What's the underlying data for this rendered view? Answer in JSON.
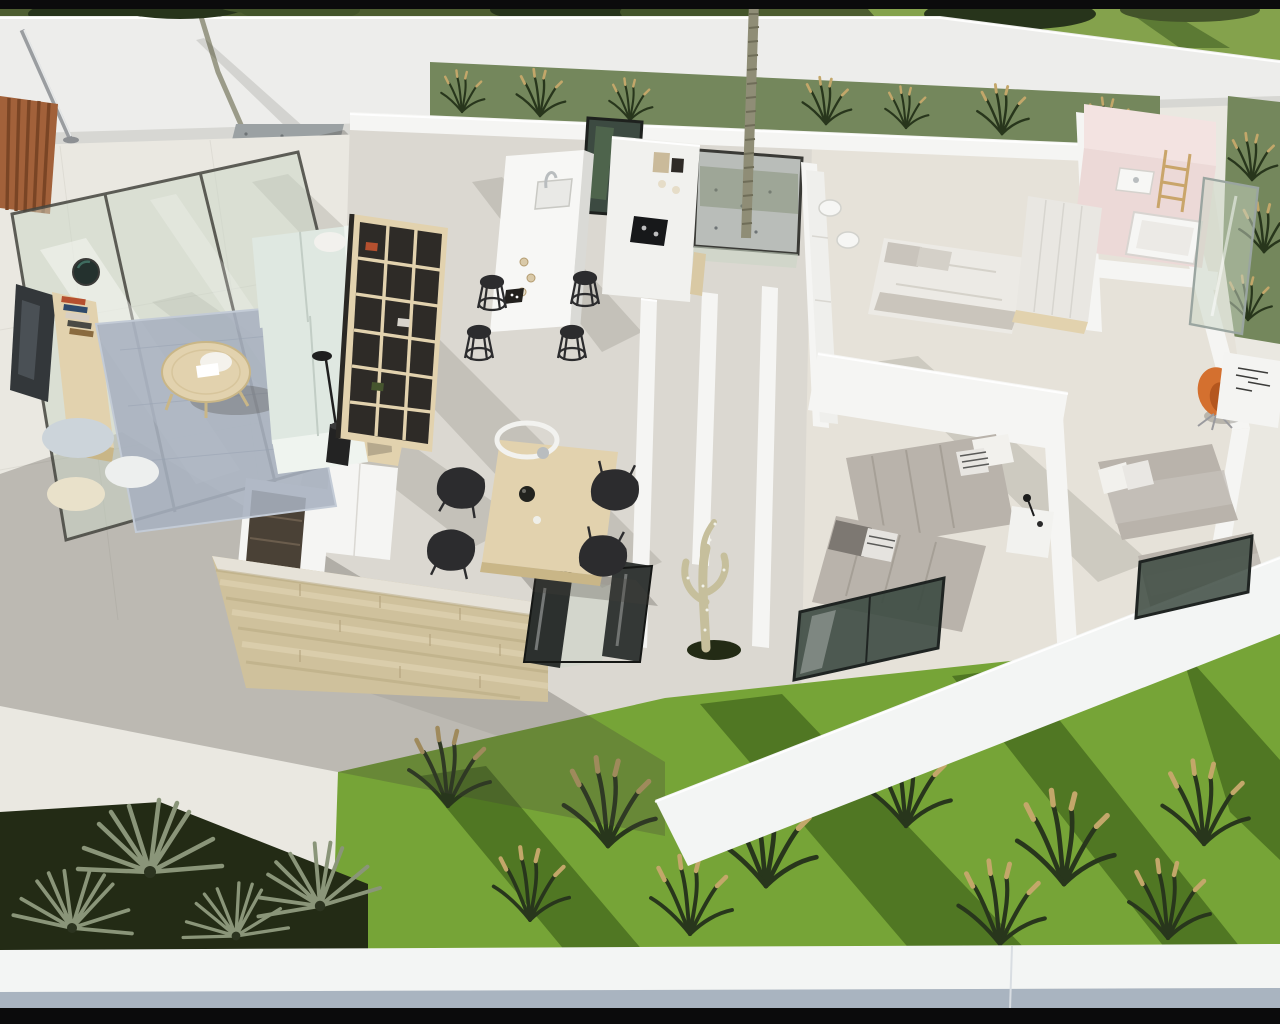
{
  "meta": {
    "scene_type": "photorealistic-3d-floorplan-render",
    "view": "aerial-dollhouse-cutaway"
  },
  "colors": {
    "letterbox": "#0b0b0c",
    "top_foliage_base": "#4e5e31",
    "foliage_dark": "#27341b",
    "foliage_mid": "#43542a",
    "top_lawn": "#84a24c",
    "top_lawn_shadow": "#5c7a34",
    "perimeter_wall": "#ededeb",
    "perimeter_wall_shade": "#d7d7d3",
    "back_garden": "#74875c",
    "wall_white": "#f5f5f3",
    "wall_cap": "#ffffff",
    "terrace_floor": "#eae8e1",
    "interior_floor": "#dbd8d1",
    "interior_floor_warm": "#e6e2d9",
    "glass_green": "#c9d5c5",
    "glass_frame": "#45453f",
    "corten": "#a2613a",
    "corten_dark": "#7a4525",
    "gravel": "#9ba1a3",
    "gravel_dark": "#6e7476",
    "tree_trunk": "#9b9b89",
    "rug_blue": "#a7b1bf",
    "wood_light": "#e2d2ae",
    "wood_mid": "#c9b687",
    "sofa_mint": "#dfe8e1",
    "sofa_highlight": "#eff4ef",
    "tv_dark": "#33373a",
    "shelf_back": "#2e2b27",
    "black_furniture": "#2c2c2e",
    "stone_light": "#e0d4b3",
    "stone_mid": "#cfc19c",
    "stone_dark": "#b7a87f",
    "cabinet_dark": "#4a4136",
    "duvet_gray": "#b9b3ab",
    "duvet_fold": "#a19b92",
    "pillow_white": "#f2f1ed",
    "pink_floor": "#ecd9d7",
    "pink_wall": "#f3e3e1",
    "orange_chair": "#d4702f",
    "orange_chair_shade": "#b4561e",
    "cactus_green": "#c6bf9c",
    "soil_dark": "#232b15",
    "lawn": "#76a437",
    "grass_tuft": "#28361c",
    "tuft_seed": "#c3a76a",
    "palm_frond": "#8a9579",
    "window_glass": "#3c4a41",
    "facade_white": "#f3f5f4",
    "facade_blue_strip": "#a9b4c0",
    "chrome": "#b9bdbf",
    "white_counter": "#f7f7f5"
  }
}
